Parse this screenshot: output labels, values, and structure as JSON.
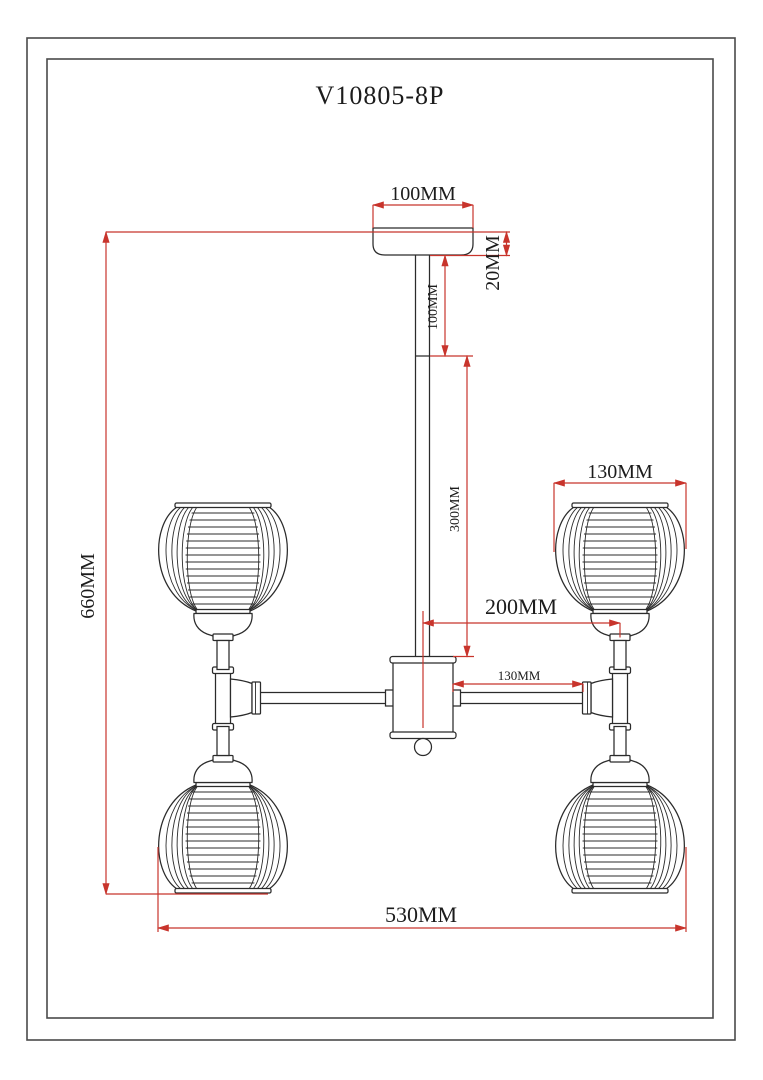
{
  "drawing": {
    "title": "V10805-8P",
    "dims": {
      "canopy_width": "100MM",
      "canopy_height": "20MM",
      "stem_upper_length": "100MM",
      "stem_lower_length": "300MM",
      "total_height": "660MM",
      "shade_diameter": "130MM",
      "center_offset": "200MM",
      "arm_length": "130MM",
      "total_width": "530MM"
    },
    "colors": {
      "dimension_line": "#c8342c",
      "drawing_line": "#2b2b2b"
    }
  }
}
